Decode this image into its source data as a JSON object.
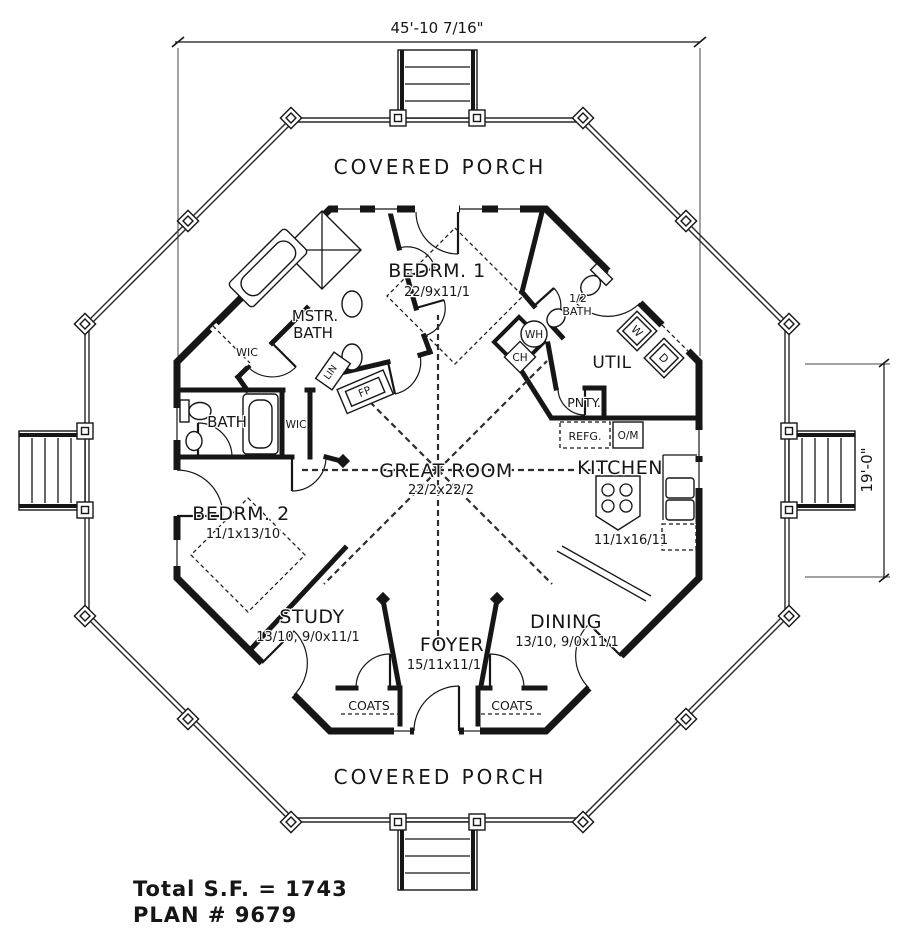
{
  "drawing": {
    "dim_overall_width": "45'-10 7/16\"",
    "dim_side": "19'-0\"",
    "porch_top": "COVERED PORCH",
    "porch_bottom": "COVERED PORCH",
    "total_sf": "Total S.F. = 1743",
    "plan_number": "PLAN # 9679"
  },
  "rooms": {
    "bedrm1": {
      "name": "BEDRM. 1",
      "dims": "22/9x11/1"
    },
    "mstr_bath_line1": "MSTR.",
    "mstr_bath_line2": "BATH",
    "wic_master": "WIC",
    "half_bath_line1": "1/2",
    "half_bath_line2": "BATH",
    "util": "UTIL",
    "pantry": "PNTY.",
    "bath": "BATH",
    "wic_bedrm2": "WIC",
    "bedrm2": {
      "name": "BEDRM. 2",
      "dims": "11/1x13/10"
    },
    "great_room": {
      "name": "GREAT ROOM",
      "dims": "22/2x22/2"
    },
    "kitchen": {
      "name": "KITCHEN",
      "dims": "11/1x16/11"
    },
    "study": {
      "name": "STUDY",
      "dims": "13/10, 9/0x11/1"
    },
    "foyer": {
      "name": "FOYER",
      "dims": "15/11x11/1"
    },
    "dining": {
      "name": "DINING",
      "dims": "13/10, 9/0x11/1"
    },
    "coats_left": "COATS",
    "coats_right": "COATS"
  },
  "fixtures": {
    "water_heater": "WH",
    "chase": "CH",
    "washer": "W",
    "dryer": "D",
    "linen": "LIN",
    "fireplace": "FP",
    "refrigerator": "REFG.",
    "oven_micro": "O/M"
  }
}
